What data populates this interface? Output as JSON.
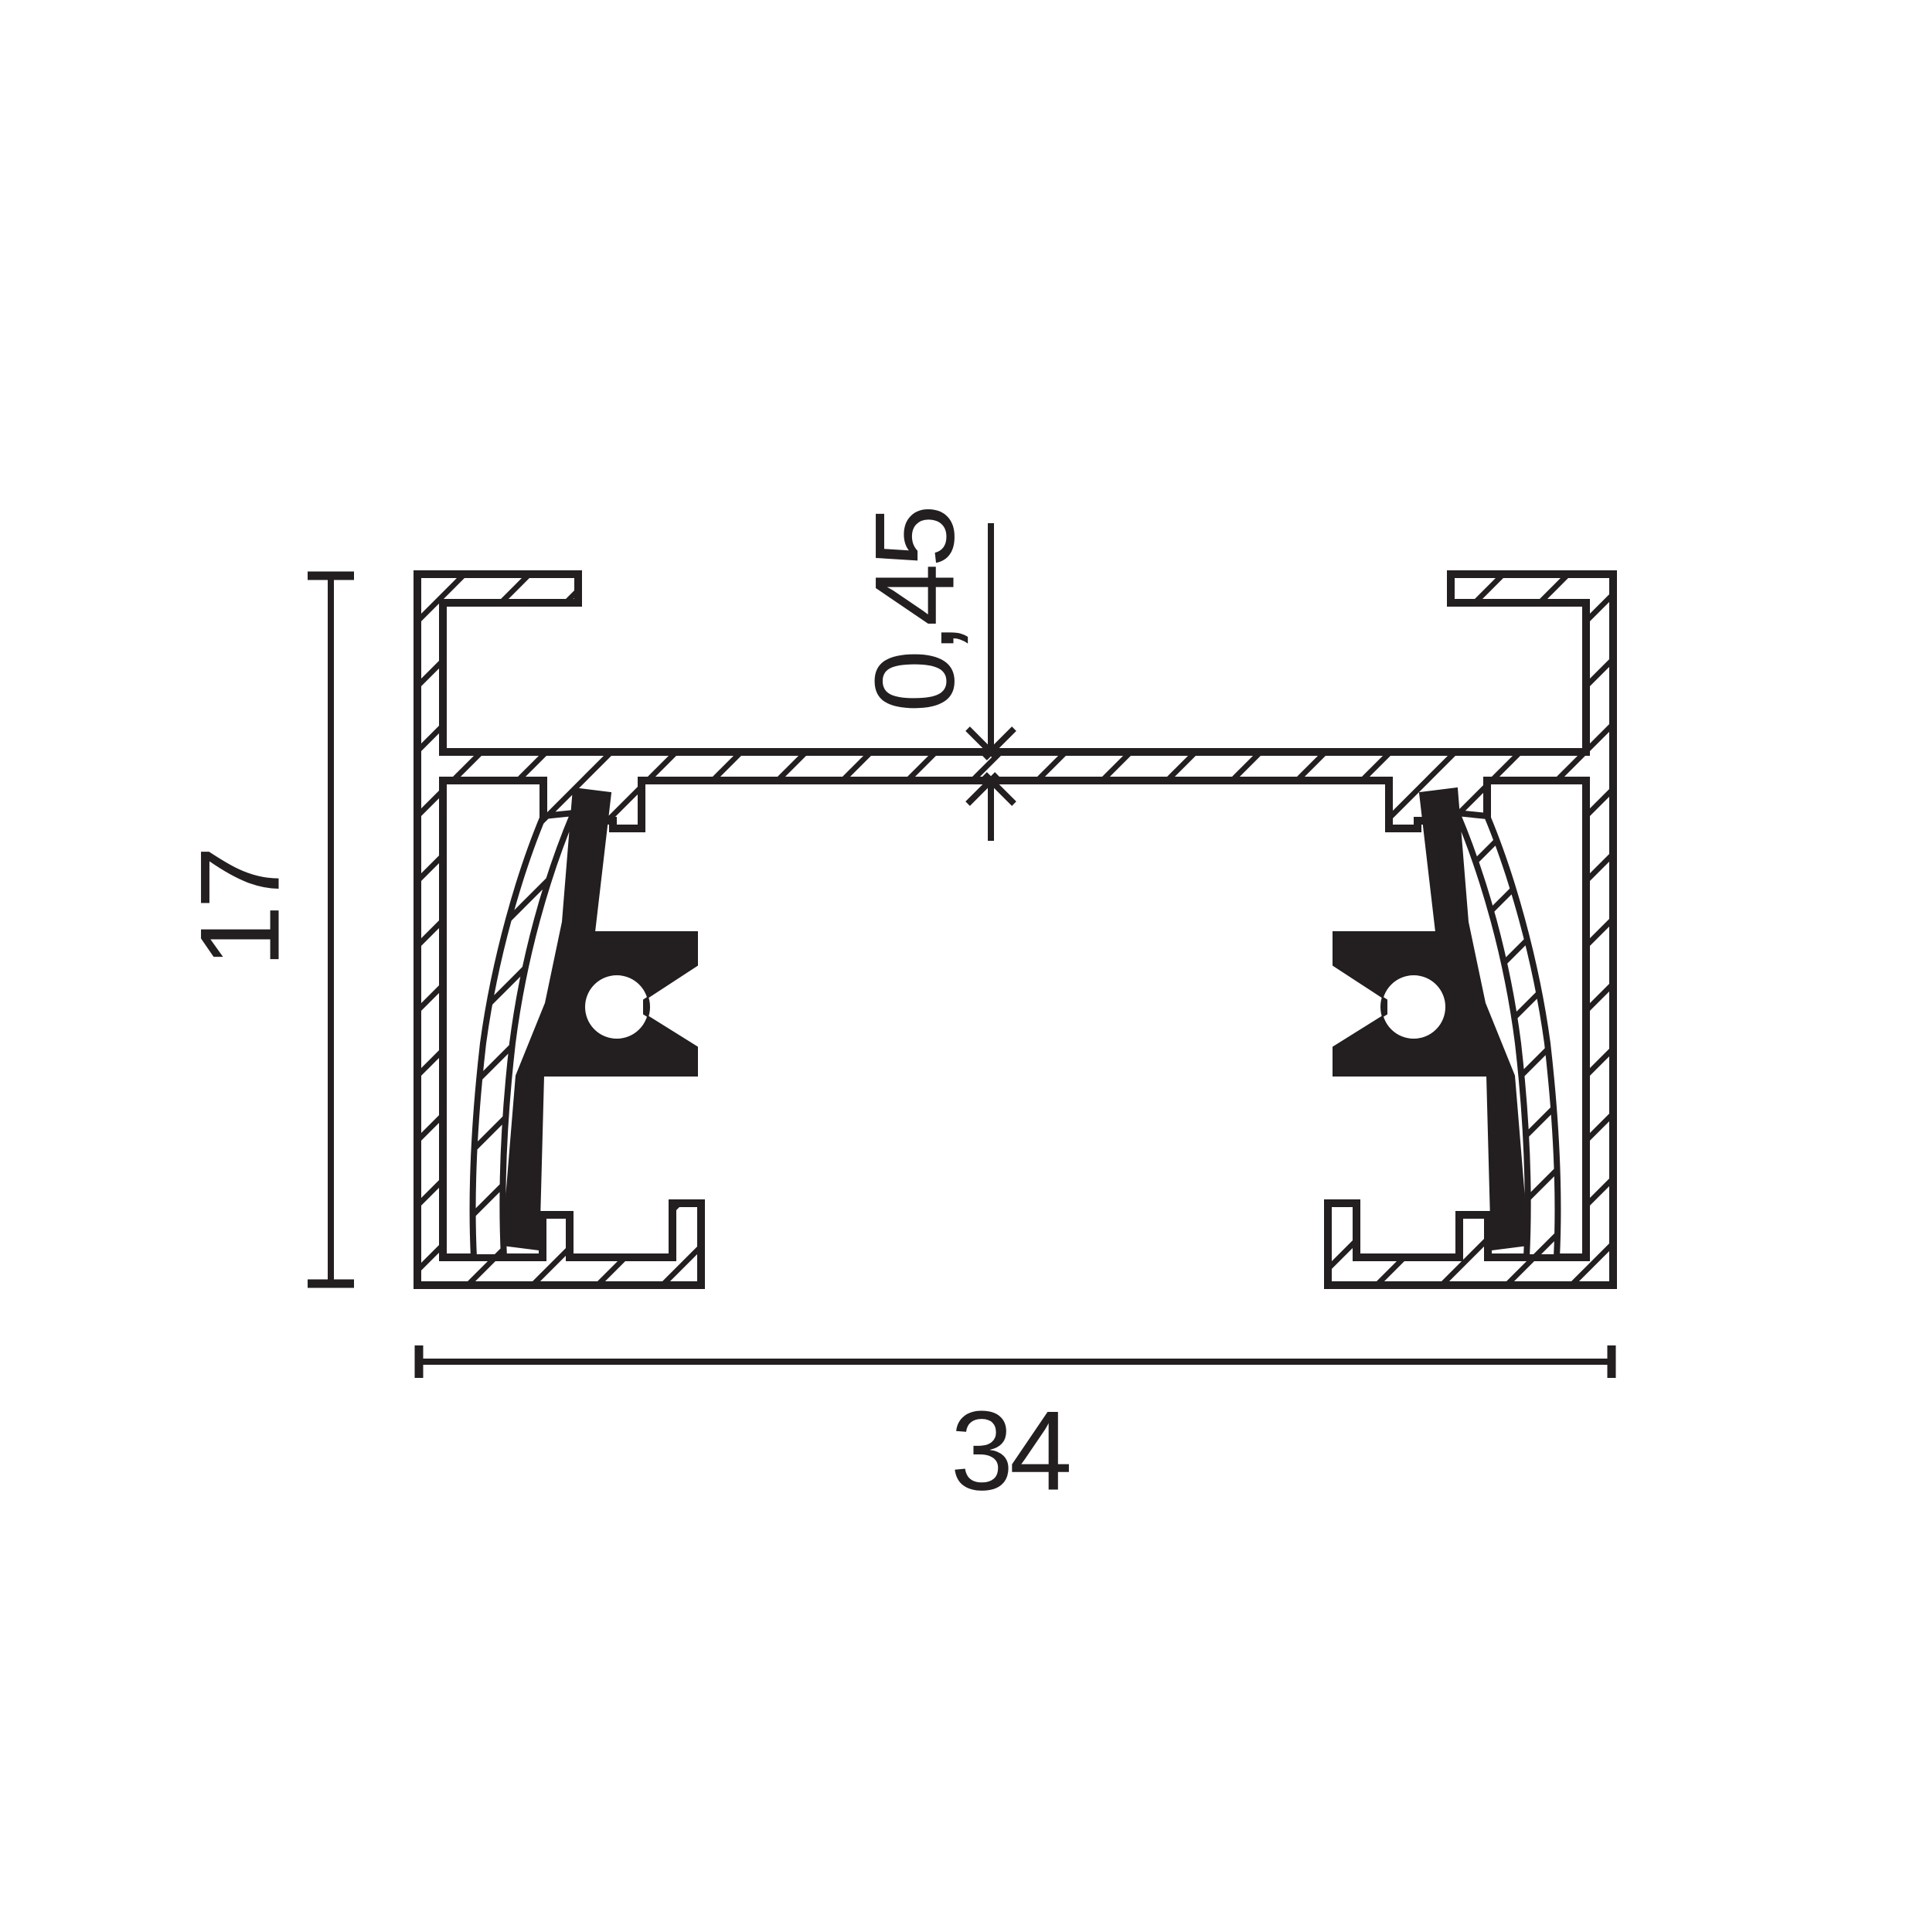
{
  "dimensions": {
    "height_label": "17",
    "width_label": "34",
    "web_thickness_label": "0,45"
  },
  "colors": {
    "ink": "#231f20",
    "background": "#ffffff"
  }
}
